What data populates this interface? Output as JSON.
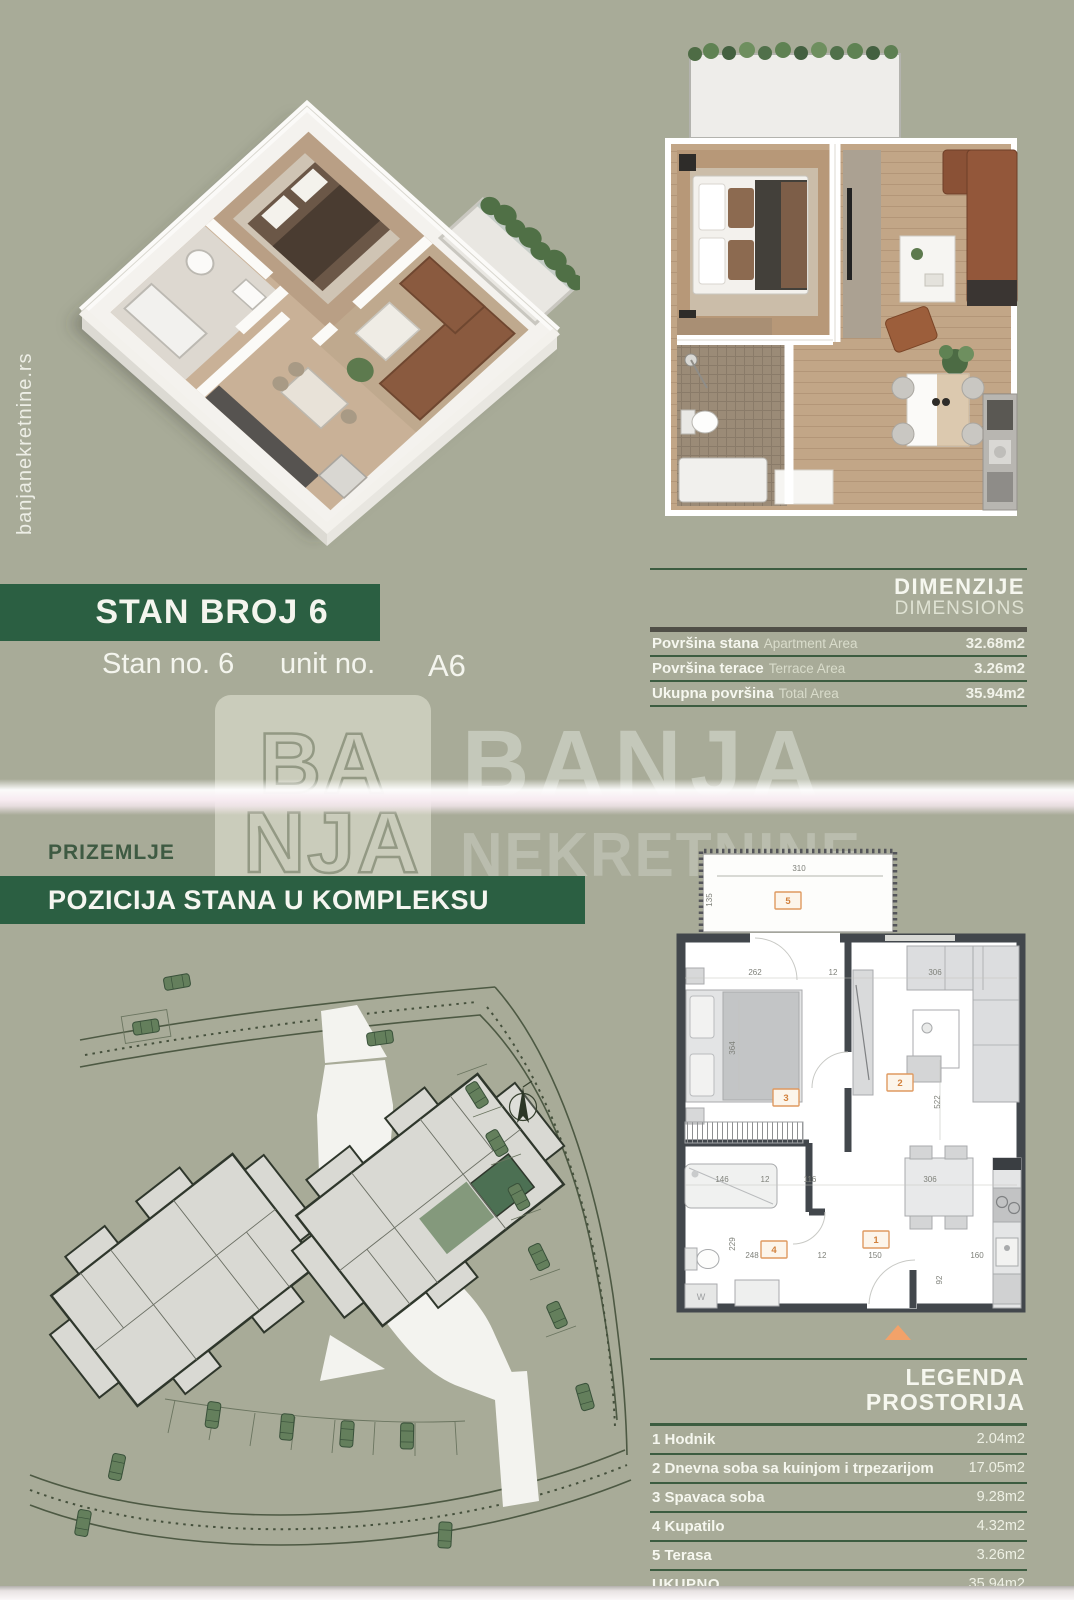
{
  "page": {
    "bg": "#a8ab98",
    "accent_green": "#2b5f42",
    "rule_green": "#3c5c40",
    "marker_orange": "#df9a60",
    "triangle_orange": "#f2a269",
    "band_pink": "#f6e9ef"
  },
  "side": {
    "website": "banjanekretnine.rs"
  },
  "unit_header": {
    "banner": "STAN BROJ 6",
    "subtitle_left": "Stan no. 6",
    "subtitle_right": "unit no.",
    "unit_code": "A6"
  },
  "dimensions_table": {
    "title": "DIMENZIJE",
    "subtitle": "DIMENSIONS",
    "rows": [
      {
        "label_sr": "Površina stana",
        "label_en": "Apartment Area",
        "value": "32.68m2"
      },
      {
        "label_sr": "Površina terace",
        "label_en": "Terrace Area",
        "value": "3.26m2"
      },
      {
        "label_sr": "Ukupna površina",
        "label_en": "Total Area",
        "value": "35.94m2"
      }
    ]
  },
  "watermark": {
    "logo_line1": "BA",
    "logo_line2": "NJA",
    "brand_line1": "BANJA",
    "brand_line2": "NEKRETNINE"
  },
  "position_section": {
    "floor_label": "PRIZEMLJE",
    "banner": "POZICIJA STANA U KOMPLEKSU"
  },
  "legend_table": {
    "title_line1": "LEGENDA",
    "title_line2": "PROSTORIJA",
    "rows": [
      {
        "label": "1 Hodnik",
        "value": "2.04m2"
      },
      {
        "label": "2 Dnevna soba sa kuinjom i trpezarijom",
        "value": "17.05m2"
      },
      {
        "label": "3 Spavaca soba",
        "value": "9.28m2"
      },
      {
        "label": "4 Kupatilo",
        "value": "4.32m2"
      },
      {
        "label": "5 Terasa",
        "value": "3.26m2"
      }
    ],
    "total": {
      "label": "UKUPNO",
      "value": "35.94m2"
    }
  },
  "floor_plan": {
    "markers": [
      "1",
      "2",
      "3",
      "4",
      "5"
    ],
    "washer_label": "W",
    "dims": [
      "310",
      "135",
      "262",
      "12",
      "306",
      "364",
      "522",
      "146",
      "12",
      "116",
      "306",
      "229",
      "248",
      "12",
      "150",
      "160",
      "92"
    ]
  }
}
